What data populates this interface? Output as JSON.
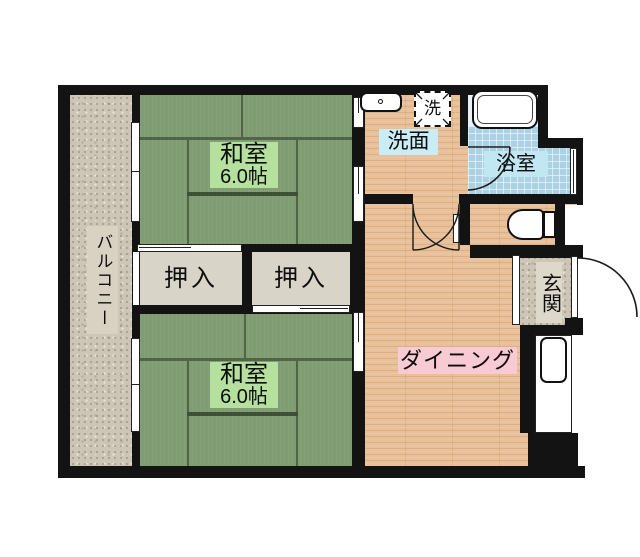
{
  "plan": {
    "balcony": {
      "label": "バルコニー"
    },
    "washitsu_top": {
      "name": "和室",
      "size": "6.0帖"
    },
    "washitsu_bottom": {
      "name": "和室",
      "size": "6.0帖"
    },
    "closet_left": {
      "label": "押入"
    },
    "closet_right": {
      "label": "押入"
    },
    "washroom": {
      "label": "洗面"
    },
    "washer": {
      "label": "洗"
    },
    "bathroom": {
      "label": "浴室"
    },
    "entrance": {
      "label": "玄関"
    },
    "dining": {
      "label": "ダイニング"
    }
  },
  "colors": {
    "wall": "#131313",
    "tatami": "#7f9c73",
    "tatami_line": "#4e6547",
    "room_label_green": "#b5e09e",
    "wood_floor": "#e9c097",
    "bath_tile": "#abd2e4",
    "label_blue": "#c9ecf5",
    "label_pink": "#f8cad3",
    "stone": "#cdc5b6",
    "closet_beige": "#d8d4c8"
  }
}
